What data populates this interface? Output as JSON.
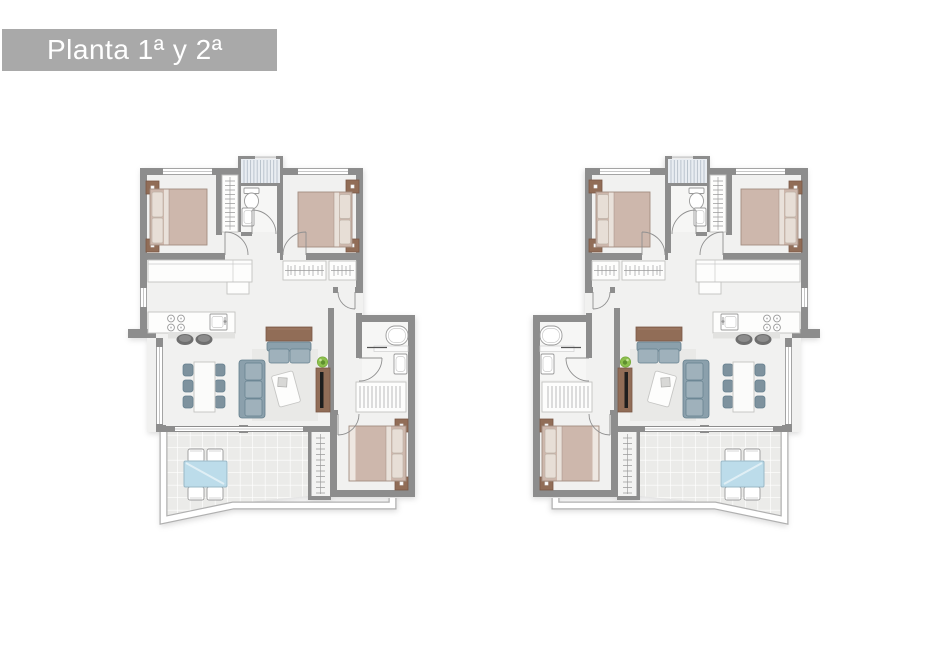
{
  "title": {
    "label": "Planta 1ª y 2ª"
  },
  "plans": [
    {
      "id": "unit-left",
      "mirrored": false
    },
    {
      "id": "unit-right",
      "mirrored": true
    }
  ],
  "legend": {
    "drawing_type": "floor-plan",
    "rooms": [
      "bedroom-1",
      "bedroom-2",
      "bedroom-3",
      "bathroom-1",
      "bathroom-2",
      "kitchen",
      "living-dining",
      "hall",
      "terrace",
      "stairs",
      "drying-area"
    ],
    "furniture": [
      "double-bed",
      "nightstand",
      "wardrobe",
      "toilet",
      "washbasin",
      "bathtub",
      "cooktop",
      "kitchen-sink",
      "bar-stool",
      "dining-table",
      "dining-chair",
      "sofa",
      "loveseat",
      "coffee-table",
      "sideboard",
      "tv-unit",
      "plant",
      "outdoor-table",
      "outdoor-chair"
    ]
  },
  "palette": {
    "banner": "#a9a9a9",
    "wall": "#8d8d8d",
    "floor": "#f1f1f0",
    "floorBath": "#f6f6f5",
    "terrace": "#ebebe9",
    "tileLine": "#ffffff",
    "rug": "#e9e9e7",
    "bed": "#cdb7ac",
    "bedEdge": "#a28d81",
    "pillow": "#e7ded6",
    "pillowEdge": "#bfb3a8",
    "wood": "#916d57",
    "woodEdge": "#7a5846",
    "sofa": "#8ba0ac",
    "cushion": "#9fb1bb",
    "sofaEdge": "#647f8d",
    "chair": "#7e929e",
    "glassTable": "#bcdcea",
    "glassEdge": "#9ab8c6",
    "plant": "#8cbf4d",
    "plantDark": "#5f8f2f",
    "stairsBg": "#e9edf2",
    "stairsLine": "#b6bfc9",
    "railCase": "#b0b0b0",
    "tv": "#1e1e1e",
    "stool": "#6f6f6f",
    "fixture": "#9a9a9a",
    "hanger": "#9a9a9a",
    "counterShade": "#e2e2e0",
    "doorArc": "#909090"
  }
}
